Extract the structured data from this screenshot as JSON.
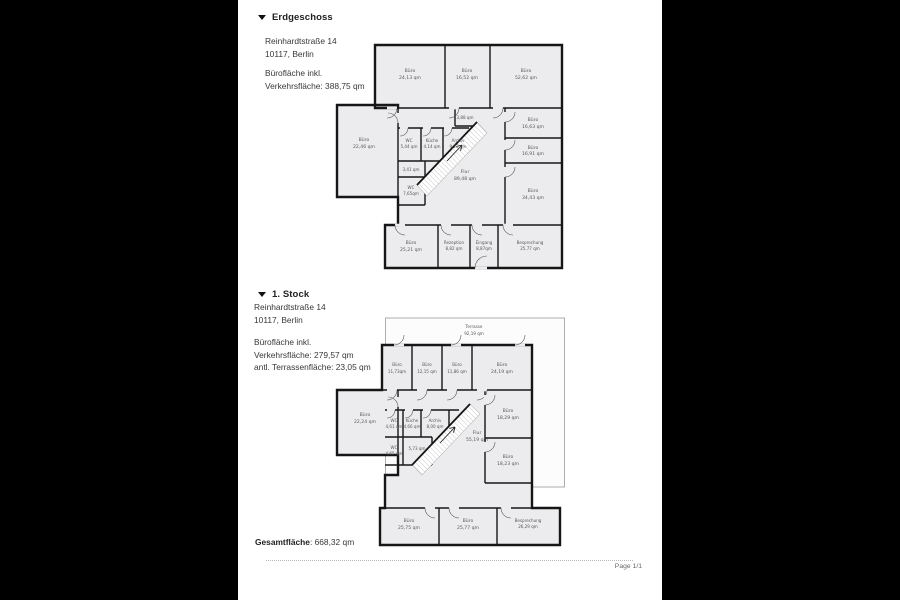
{
  "icons": {
    "section_marker": "triangle-down"
  },
  "floors": [
    {
      "title": "Erdgeschoss",
      "address1": "Reinhardtstraße 14",
      "address2": "10117, Berlin",
      "areaLine1": "Bürofläche inkl.",
      "areaLine2": "Verkehrsfläche: 388,75 qm",
      "rooms": [
        {
          "name": "Büro",
          "area": "24,13 qm"
        },
        {
          "name": "Büro",
          "area": "16,52 qm"
        },
        {
          "name": "Büro",
          "area": "52,62 qm"
        },
        {
          "name": "Büro",
          "area": "22,46 qm"
        },
        {
          "name": "WC",
          "area": "5,44 qm"
        },
        {
          "name": "Küche",
          "area": "4,14 qm"
        },
        {
          "name": "Archiv",
          "area": "9,23 qm"
        },
        {
          "name": "",
          "area": "3,88 qm"
        },
        {
          "name": "",
          "area": "3,41 qm"
        },
        {
          "name": "WC",
          "area": "7,65qm"
        },
        {
          "name": "Flur",
          "area": "89,48 qm"
        },
        {
          "name": "Büro",
          "area": "16,63 qm"
        },
        {
          "name": "Büro",
          "area": "16,91 qm"
        },
        {
          "name": "Büro",
          "area": "34,43 qm"
        },
        {
          "name": "Büro",
          "area": "25,21 qm"
        },
        {
          "name": "Rezeption",
          "area": "8,82 qm"
        },
        {
          "name": "Eingang",
          "area": "8,87qm"
        },
        {
          "name": "Besprechung",
          "area": "25,77 qm"
        }
      ]
    },
    {
      "title": "1. Stock",
      "address1": "Reinhardtstraße 14",
      "address2": "10117, Berlin",
      "areaLine1": "Bürofläche inkl.",
      "areaLine2": "Verkehrsfläche: 279,57 qm",
      "areaLine3": "antl. Terrassenfläche: 23,05 qm",
      "rooms": [
        {
          "name": "Terrasse",
          "area": "92,19 qm"
        },
        {
          "name": "Büro",
          "area": "11,73qm"
        },
        {
          "name": "Büro",
          "area": "12,15 qm"
        },
        {
          "name": "Büro",
          "area": "11,86 qm"
        },
        {
          "name": "Büro",
          "area": "24,19 qm"
        },
        {
          "name": "Büro",
          "area": "22,24 qm"
        },
        {
          "name": "WC",
          "area": "4,61 qm"
        },
        {
          "name": "Küche",
          "area": "4,66 qm"
        },
        {
          "name": "Archiv",
          "area": "8,00 qm"
        },
        {
          "name": "WC",
          "area": "4,65 qm"
        },
        {
          "name": "",
          "area": "5,73 qm"
        },
        {
          "name": "Flur",
          "area": "55,19 qm"
        },
        {
          "name": "Büro",
          "area": "18,29 qm"
        },
        {
          "name": "Büro",
          "area": "18,23 qm"
        },
        {
          "name": "Büro",
          "area": "25,75 qm"
        },
        {
          "name": "Büro",
          "area": "25,77 qm"
        },
        {
          "name": "Besprechung",
          "area": "26,29 qm"
        }
      ]
    }
  ],
  "footer": {
    "total_label": "Gesamtfläche",
    "total_value": ": 668,32 qm",
    "page_indicator": "Page 1/1"
  }
}
